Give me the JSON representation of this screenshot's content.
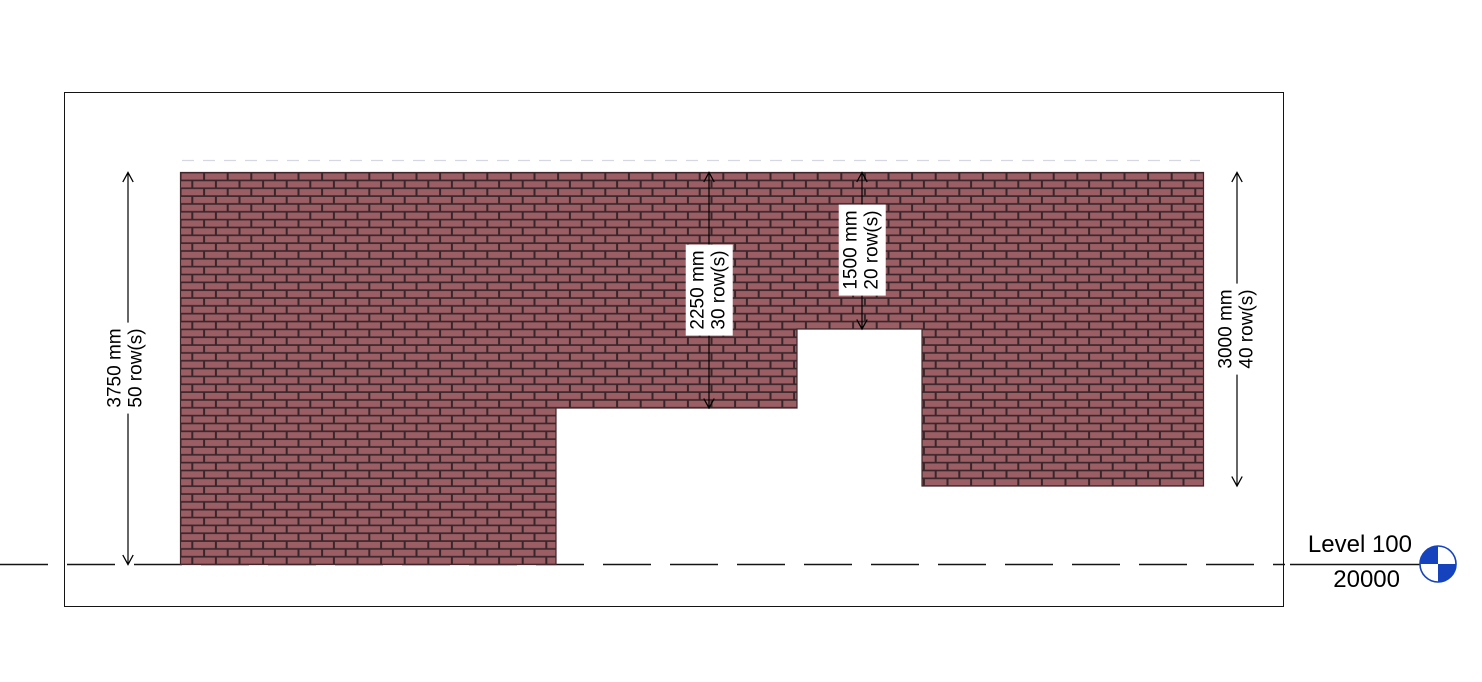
{
  "view": {
    "type_label": "brick-wall-elevation",
    "level": {
      "name": "Level 100",
      "elevation": "20000",
      "marker_color": "#1543bd"
    }
  },
  "wall": {
    "brick_color": "#9a5e64",
    "mortar_color": "#38262a",
    "outline_color": "#3f272b"
  },
  "dimensions": {
    "left": {
      "value": "3750 mm",
      "rows": "50 row(s)"
    },
    "middle_left": {
      "value": "2250 mm",
      "rows": "30 row(s)"
    },
    "middle_right": {
      "value": "1500 mm",
      "rows": "20 row(s)"
    },
    "right": {
      "value": "3000 mm",
      "rows": "40 row(s)"
    }
  }
}
